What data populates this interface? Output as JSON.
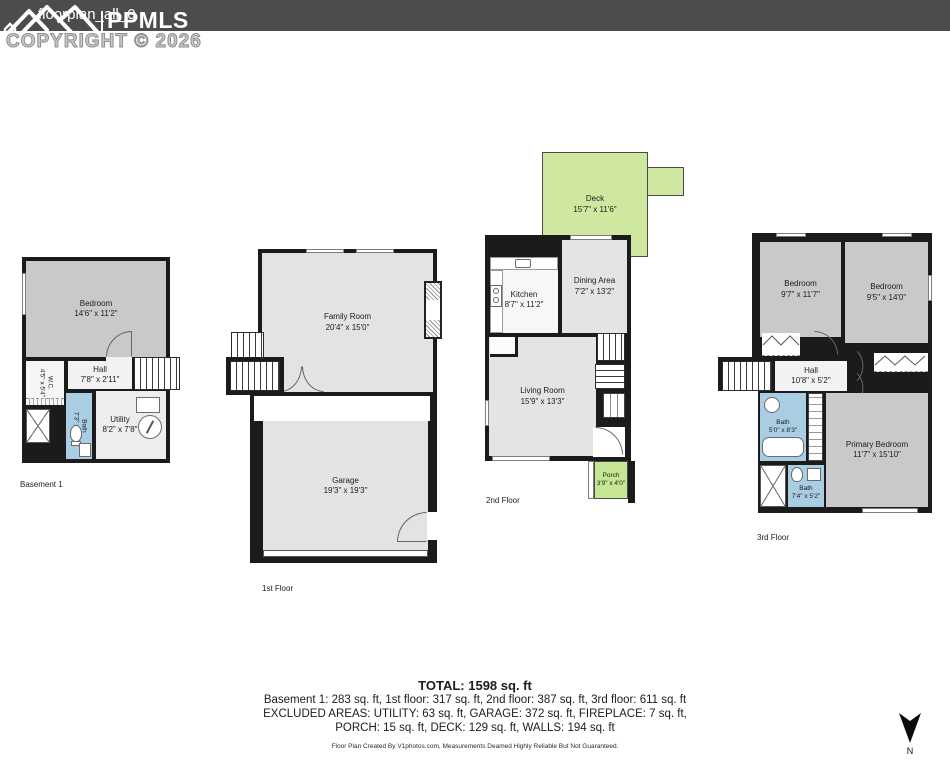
{
  "header": {
    "filename": "floorplan_all_0",
    "brand": "PPMLS",
    "copyright": "COPYRIGHT © 2026"
  },
  "floors": [
    {
      "label": "Basement 1",
      "rooms": [
        {
          "name": "Bedroom",
          "dims": "14'6\" x 11'2\""
        },
        {
          "name": "Hall",
          "dims": "7'8\" x 2'11\""
        },
        {
          "name": "W.C.",
          "dims": "4'5\" x 5'4\""
        },
        {
          "name": "Bath",
          "dims": "7'3\" x 7'8\""
        },
        {
          "name": "Utility",
          "dims": "8'2\" x 7'8\""
        }
      ]
    },
    {
      "label": "1st Floor",
      "rooms": [
        {
          "name": "Family Room",
          "dims": "20'4\" x 15'0\""
        },
        {
          "name": "Garage",
          "dims": "19'3\" x 19'3\""
        }
      ]
    },
    {
      "label": "2nd Floor",
      "rooms": [
        {
          "name": "Deck",
          "dims": "15'7\" x 11'6\""
        },
        {
          "name": "Kitchen",
          "dims": "8'7\" x 11'2\""
        },
        {
          "name": "Dining Area",
          "dims": "7'2\" x 13'2\""
        },
        {
          "name": "Living Room",
          "dims": "15'9\" x 13'3\""
        },
        {
          "name": "Porch",
          "dims": "3'9\" x 4'0\""
        }
      ]
    },
    {
      "label": "3rd Floor",
      "rooms": [
        {
          "name": "Bedroom",
          "dims": "9'7\" x 11'7\""
        },
        {
          "name": "Bedroom",
          "dims": "9'5\" x 14'0\""
        },
        {
          "name": "Hall",
          "dims": "10'8\" x 5'2\""
        },
        {
          "name": "Bath",
          "dims": "5'0\" x 8'3\""
        },
        {
          "name": "Primary Bedroom",
          "dims": "11'7\" x 15'10\""
        },
        {
          "name": "Bath",
          "dims": "7'4\" x 5'2\""
        }
      ]
    }
  ],
  "summary": {
    "total": "TOTAL: 1598 sq. ft",
    "floors_line": "Basement 1: 283 sq. ft, 1st floor: 317 sq. ft, 2nd floor: 387 sq. ft, 3rd floor: 611 sq. ft",
    "excluded_line1": "EXCLUDED AREAS: UTILITY: 63 sq. ft, GARAGE: 372 sq. ft, FIREPLACE: 7 sq. ft,",
    "excluded_line2": "PORCH: 15 sq. ft, DECK: 129 sq. ft, WALLS: 194 sq. ft"
  },
  "footer": {
    "credit": "Floor Plan Created By V1photos.com, Measurements Deamed Highly Reliable But Not Guaranteed.",
    "compass_label": "N"
  },
  "colors": {
    "wall": "#1b1b1b",
    "header_bar": "#4c4c4c",
    "room_dark_gray": "#c9c9c9",
    "room_light_gray": "#e4e4e4",
    "bath_blue": "#a9cde2",
    "deck_green": "#cfe8a0",
    "porch_green": "#c5e693"
  }
}
